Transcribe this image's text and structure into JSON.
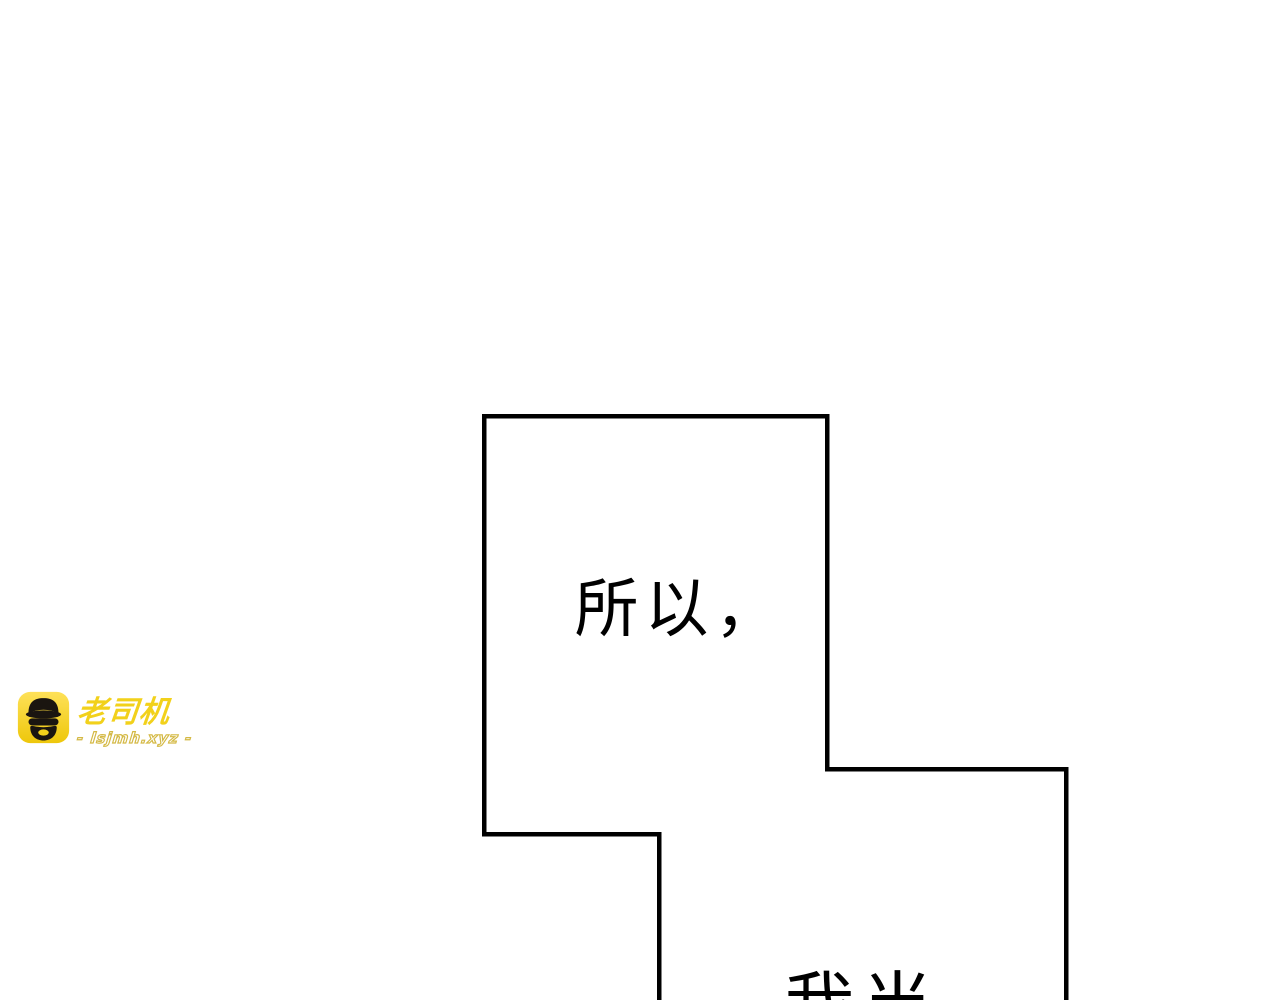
{
  "canvas": {
    "width": 1280,
    "height": 1000,
    "background": "#ffffff"
  },
  "panels": {
    "border_color": "#000000",
    "fill_color": "#ffffff",
    "panel1": {
      "dialogue": "所以，"
    },
    "panel2": {
      "dialogue_partial": "我当"
    }
  },
  "watermark": {
    "brand": "老司机",
    "site": "- lsjmh.xyz -",
    "icon": "driver-face-icon",
    "colors": {
      "badge_yellow_light": "#fee158",
      "badge_yellow_dark": "#eec70b",
      "face_black": "#1a1510",
      "brand_yellow": "#f2d11b",
      "outline_white": "#ffffff",
      "site_outline": "#d4b945"
    }
  }
}
